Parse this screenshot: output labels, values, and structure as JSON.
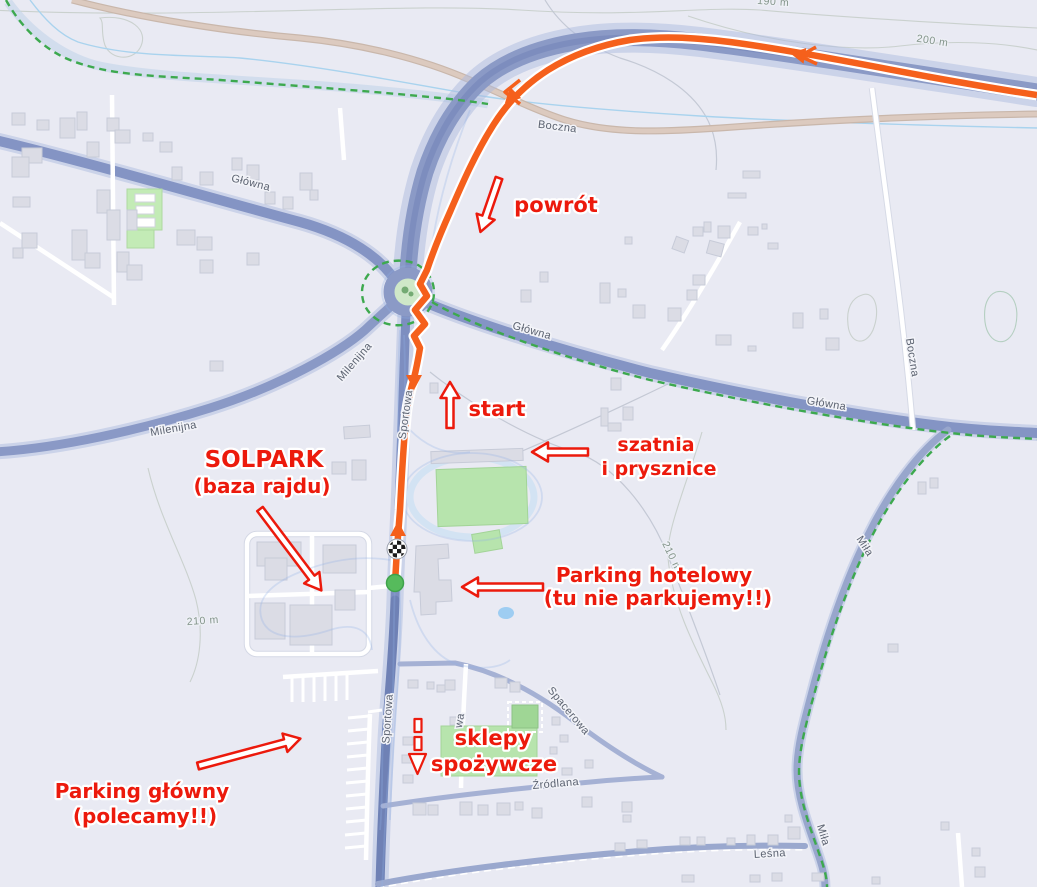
{
  "annotations": {
    "powrot": "powrót",
    "start": "start",
    "szatnia_line1": "szatnia",
    "szatnia_line2": "i prysznice",
    "solpark_line1": "SOLPARK",
    "solpark_line2": "(baza rajdu)",
    "parking_hotelowy_line1": "Parking hotelowy",
    "parking_hotelowy_line2": "(tu nie parkujemy!!)",
    "parking_glowny_line1": "Parking główny",
    "parking_glowny_line2": "(polecamy!!)",
    "sklepy_line1": "sklepy",
    "sklepy_line2": "spożywcze"
  },
  "streets": {
    "glowna": "Główna",
    "boczna": "Boczna",
    "milenijna": "Milenijna",
    "sportowa": "Sportowa",
    "spacerowa": "Spacerowa",
    "zrodlana": "Źródlana",
    "lesna": "Leśna",
    "mila": "Miła",
    "partial": "wa"
  },
  "contour_labels": {
    "c190": "190 m",
    "c200": "200 m",
    "c210": "210 m"
  },
  "markers": {
    "start_point": "green-dot",
    "finish_point": "checkered-flag"
  },
  "colors": {
    "route": "#f5601c",
    "annotation_red": "#ec1a0c",
    "major_road": "#8494c4",
    "start_marker_green": "#56bb5c",
    "path_dashed_green": "#3da94e",
    "water": "#a9d3ee",
    "green_area": "#b7e4ad",
    "background": "#e9eaf3"
  }
}
